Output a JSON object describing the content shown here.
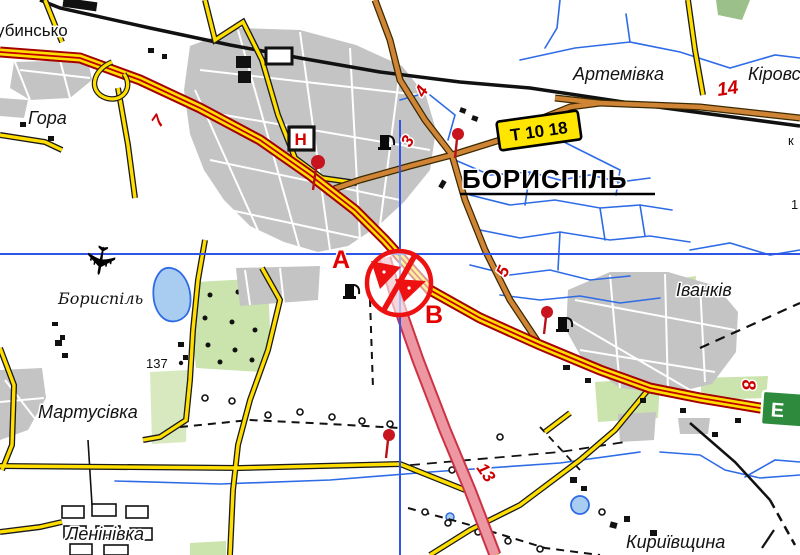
{
  "map": {
    "settlement_labels": {
      "top_left_partial": "убинсько",
      "hora": "Гора",
      "artemivka": "Артемівка",
      "kirov_partial": "Кіровське",
      "boryspil_city": "БОРИСПІЛЬ",
      "ivankiv": "Іванків",
      "martusivka": "Мартусівка",
      "leninivka": "Ленінівка",
      "kyryivshchyna": "Кириївщина",
      "boryspil_airport": "Бориспіль"
    },
    "road_numbers": {
      "n7": "7",
      "n4": "4",
      "n3": "3",
      "n14": "14",
      "n5": "5",
      "n8": "8",
      "n13": "13"
    },
    "signs": {
      "t_road": "Т 10 18",
      "e_road": "Е"
    },
    "route_markers": {
      "a": "А",
      "b": "В"
    },
    "poi": {
      "hospital": "Н"
    },
    "elevation": {
      "p137": "137"
    },
    "edge_fragments": {
      "k": "к",
      "one": "1"
    },
    "colors": {
      "road_yellow": "#FFDE00",
      "highway_casing": "#A50000",
      "highway_center": "#C00000",
      "secondary_orange": "#D08436",
      "motorway_pink": "#EC97A2",
      "motorway_casing": "#CC3344",
      "water": "#2E6BE6",
      "crosshair": "#2F55E8",
      "urban_gray": "#C4C4C4",
      "green_area": "#CBE3AC",
      "sign_green": "#2E8B3D",
      "sign_yellow": "#FFE500",
      "marker_red": "#EE1111"
    }
  }
}
